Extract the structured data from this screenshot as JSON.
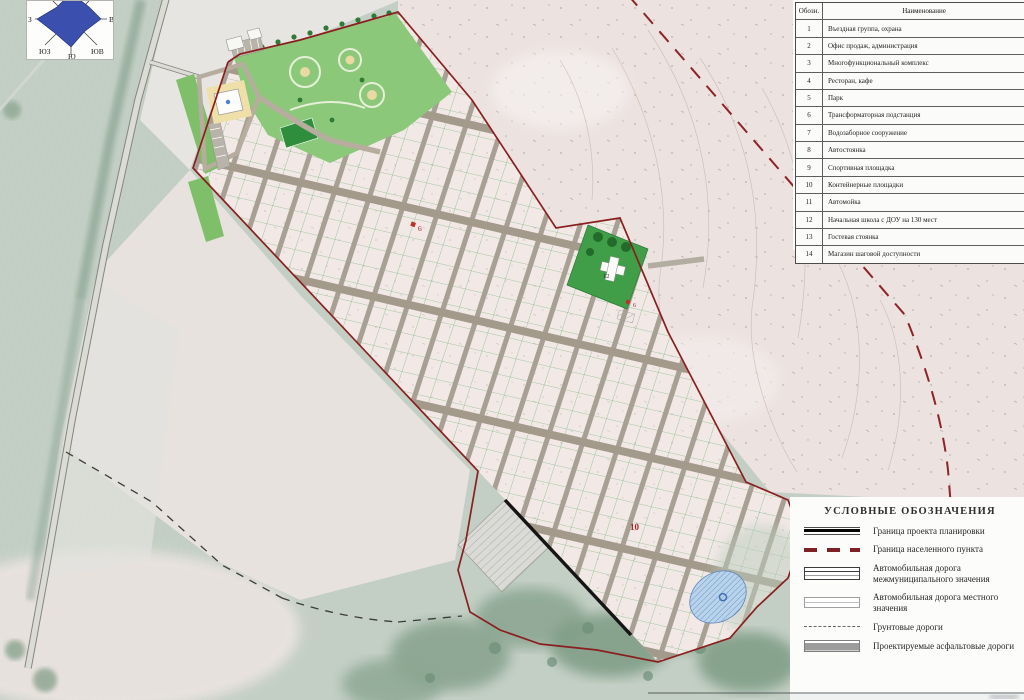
{
  "panel_table": {
    "header": {
      "symbol": "Обозн.",
      "name": "Наименование"
    },
    "rows": [
      {
        "num": "1",
        "name": "Въездная группа, охрана"
      },
      {
        "num": "2",
        "name": "Офис продаж, администрация"
      },
      {
        "num": "3",
        "name": "Многофункциональный комплекс"
      },
      {
        "num": "4",
        "name": "Ресторан, кафе"
      },
      {
        "num": "5",
        "name": "Парк"
      },
      {
        "num": "6",
        "name": "Трансформаторная подстанция"
      },
      {
        "num": "7",
        "name": "Водозаборное сооружение"
      },
      {
        "num": "8",
        "name": "Автостоянка"
      },
      {
        "num": "9",
        "name": "Спортивная площадка"
      },
      {
        "num": "10",
        "name": "Контейнерные площадки"
      },
      {
        "num": "11",
        "name": "Автомойка"
      },
      {
        "num": "12",
        "name": "Начальная школа с ДОУ на 130 мест"
      },
      {
        "num": "13",
        "name": "Гостевая стоянка"
      },
      {
        "num": "14",
        "name": "Магазин шаговой доступности"
      }
    ]
  },
  "legend": {
    "title": "УСЛОВНЫЕ ОБОЗНАЧЕНИЯ",
    "items": [
      {
        "label": "Граница проекта планировки",
        "symbol": "thick-black-line"
      },
      {
        "label": "Граница населенного пункта",
        "symbol": "dark-red-dashed-line"
      },
      {
        "label": "Автомобильная дорога межмуниципального значения",
        "symbol": "road-double-line-box"
      },
      {
        "label": "Автомобильная дорога местного значения",
        "symbol": "road-single-line-box"
      },
      {
        "label": "Грунтовые дороги",
        "symbol": "gray-dashed-line"
      },
      {
        "label": "Проектируемые асфальтовые дороги",
        "symbol": "gray-filled-bar"
      }
    ]
  },
  "compass": {
    "west": "З",
    "east": "В",
    "south": "Ю",
    "southwest": "ЮЗ",
    "southeast": "ЮВ"
  },
  "map_markers": [
    {
      "label": "6"
    },
    {
      "label": "6"
    },
    {
      "label": "10"
    },
    {
      "label": "12"
    }
  ],
  "colors": {
    "boundary_red": "#8a1f1f",
    "project_boundary_black": "#151515",
    "site_fill": "#f2e9e6",
    "road_tan": "#a8a094",
    "parcel_green": "#51a55c",
    "park_green": "#8bc879",
    "school_green": "#3f9e47",
    "pond_blue": "#b9d3ea",
    "compass_blue": "#3a4fae"
  }
}
